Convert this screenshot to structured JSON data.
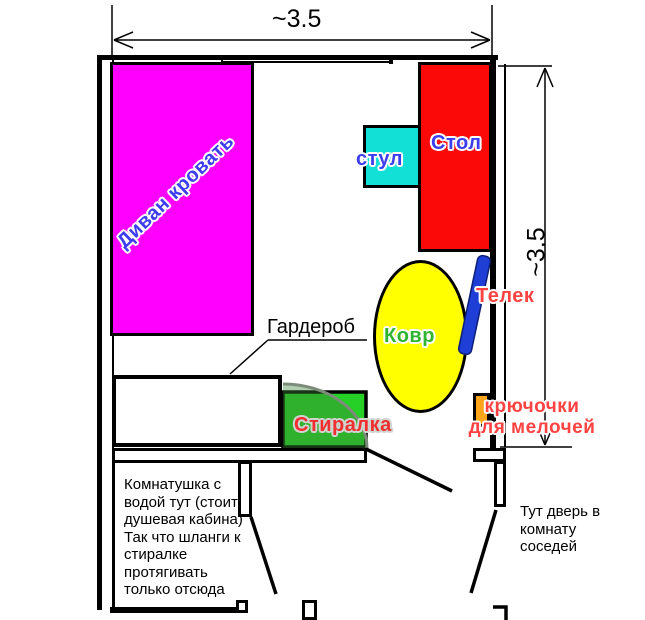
{
  "plan": {
    "dimensions": {
      "width_label": "~3.5",
      "height_label": "~3.5"
    },
    "furniture": {
      "sofa_bed": {
        "label": "Диван кровать",
        "fill": "#FF00FF",
        "label_color": "#3C3CF0"
      },
      "chair": {
        "label": "стул",
        "fill": "#12DFD6",
        "label_color": "#3C3CF0"
      },
      "table": {
        "label": "Стол",
        "fill": "#FB0909",
        "label_color": "#3C3CF0"
      },
      "carpet": {
        "label": "Ковр",
        "fill": "#FFFF00",
        "label_color": "#2FB52F"
      },
      "tv": {
        "label": "Телек",
        "fill": "#1E3ED6",
        "label_color": "#FF4242"
      },
      "wardrobe": {
        "label": "Гардероб",
        "fill": "#FFFFFF",
        "label_color": "#000000"
      },
      "washer": {
        "label": "Стиралка",
        "fill": "#27D027",
        "label_color": "#F03030"
      },
      "hooks": {
        "label": "крючочки\nдля мелочей",
        "fill": "#FFA51C",
        "label_color": "#FF4242"
      }
    },
    "notes": {
      "bathroom": "Комнатушка с\nводой тут (стоит\nдушевая кабина)\nТак что шланги к\nстиралке\nпротягивать\nтолько отсюда",
      "neighbors_door": "Тут дверь в\nкомнату\nсоседей"
    }
  }
}
